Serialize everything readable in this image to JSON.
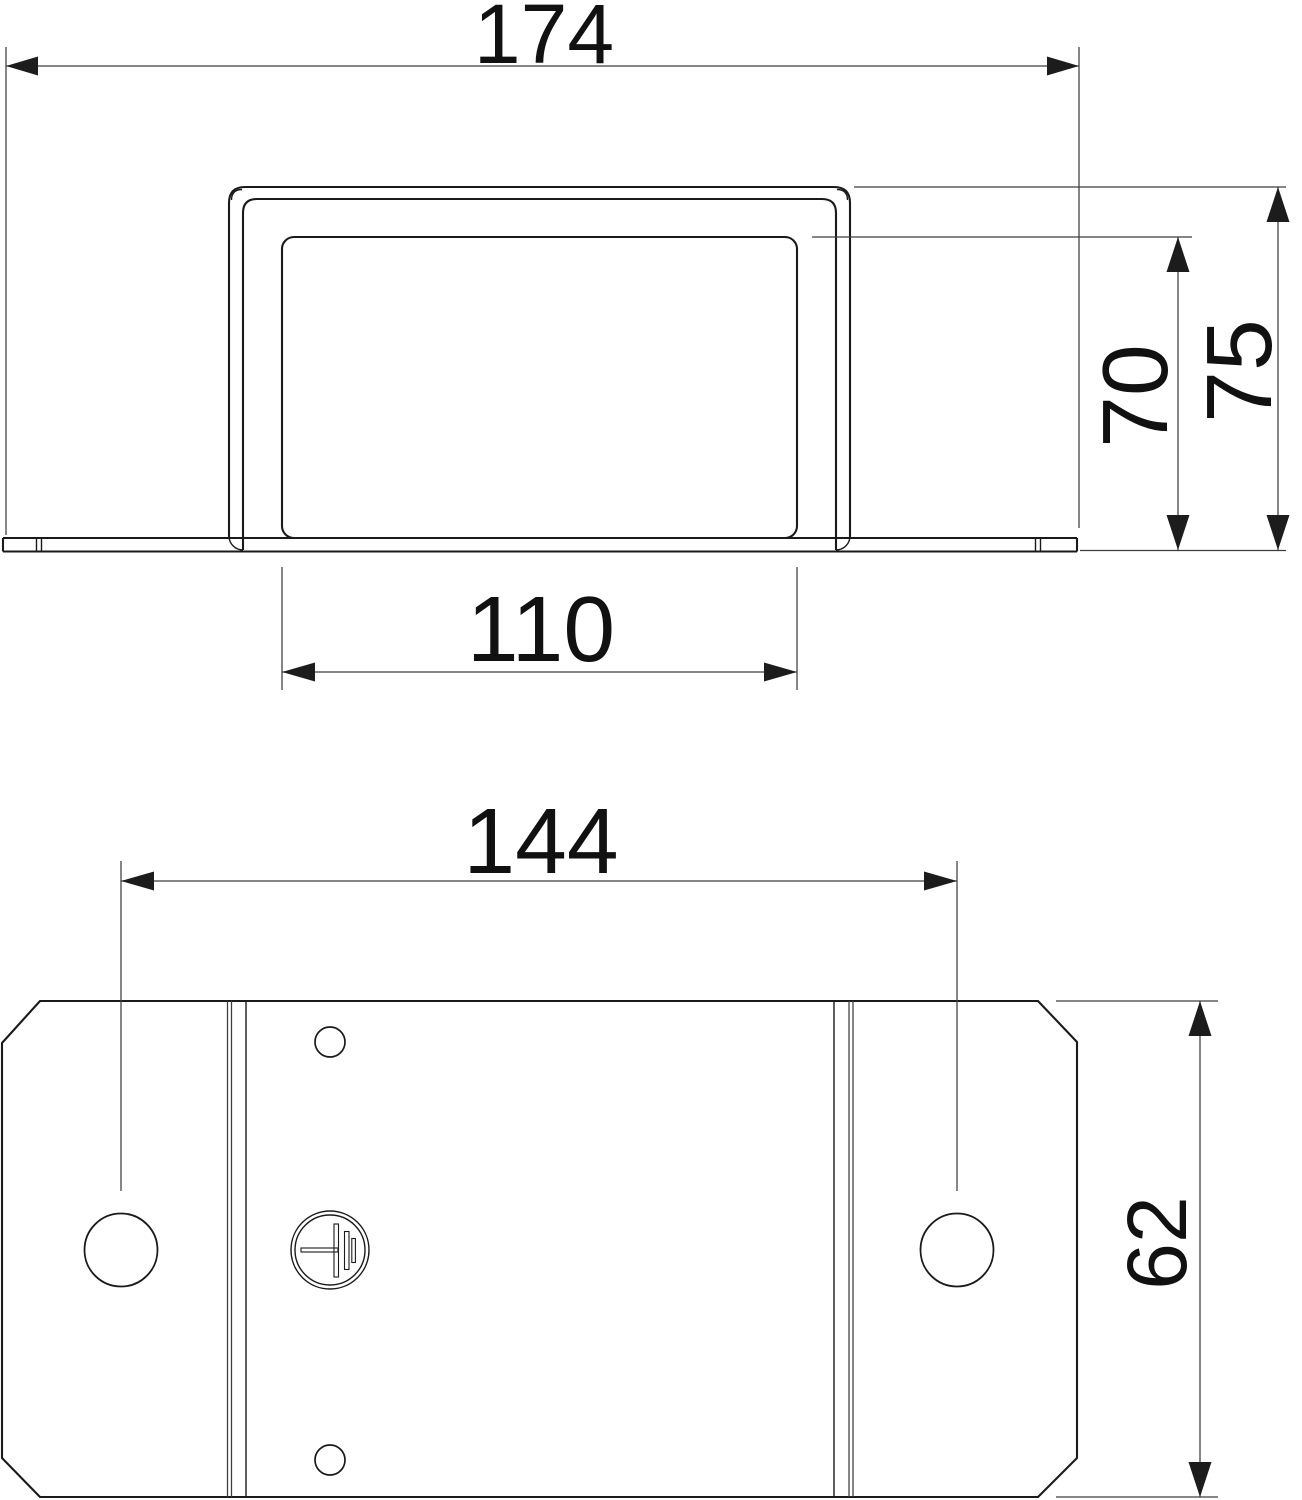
{
  "dimensions": {
    "overall_width": "174",
    "opening_width": "110",
    "inner_height": "70",
    "overall_height": "75",
    "hole_spacing": "144",
    "plate_depth": "62"
  },
  "symbols": {
    "earth_ground": "earth-ground-symbol"
  },
  "colors": {
    "background": "#ffffff",
    "part_line": "#1a1a1a",
    "dimension_line": "#3d3d3d",
    "text": "#111111"
  }
}
